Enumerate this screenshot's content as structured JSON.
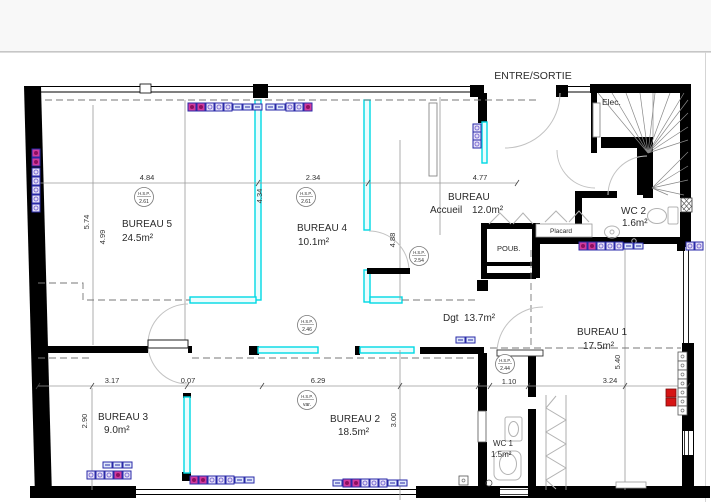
{
  "colors": {
    "wall": "#000000",
    "partition_highlight": "#00d9e4",
    "symbol_blue": "#2a2aa8",
    "symbol_magenta": "#d23c9e",
    "symbol_red": "#d61414",
    "line_gray": "#9a9a9a",
    "header_band": "#f8f8f8"
  },
  "plan": {
    "entry_label": "ENTRE/SORTIE",
    "elec_label": "Elec.",
    "hsp_label": "H.S.P.",
    "rooms": {
      "bureau1": {
        "name": "BUREAU 1",
        "area": "17.5m²"
      },
      "bureau2": {
        "name": "BUREAU 2",
        "area": "18.5m²"
      },
      "bureau3": {
        "name": "BUREAU 3",
        "area": "9.0m²"
      },
      "bureau4": {
        "name": "BUREAU 4",
        "area": "10.1m²"
      },
      "bureau5": {
        "name": "BUREAU 5",
        "area": "24.5m²"
      },
      "accueil": {
        "name": "BUREAU",
        "subname": "Accueil",
        "area": "12.0m²"
      },
      "wc1": {
        "name": "WC 1",
        "area": "1.5m²"
      },
      "wc2": {
        "name": "WC 2",
        "area": "1.6m²"
      },
      "dgt": {
        "name": "Dgt",
        "area": "13.7m²"
      }
    },
    "closets": {
      "poub": "POUB.",
      "placard": "Placard"
    },
    "hsp": {
      "bureau5": "2.61",
      "bureau4": "2.61",
      "accueil": "2.54",
      "corridor": "2.46",
      "dgt": "2.44",
      "bureau2": "var."
    },
    "dims": {
      "top_left": "4.84",
      "top_mid": "2.34",
      "top_right": "4.77",
      "v_b5_a": "5.74",
      "v_b5_b": "4.99",
      "v_b4": "4.34",
      "v_accueil": "4.88",
      "bot_b3": "3.17",
      "bot_gap": "0.07",
      "bot_b2": "6.29",
      "v_b2": "3.00",
      "v_b3": "2.90",
      "v_b1": "5.40",
      "dgt_w": "1.10",
      "b1_w": "3.24"
    }
  }
}
